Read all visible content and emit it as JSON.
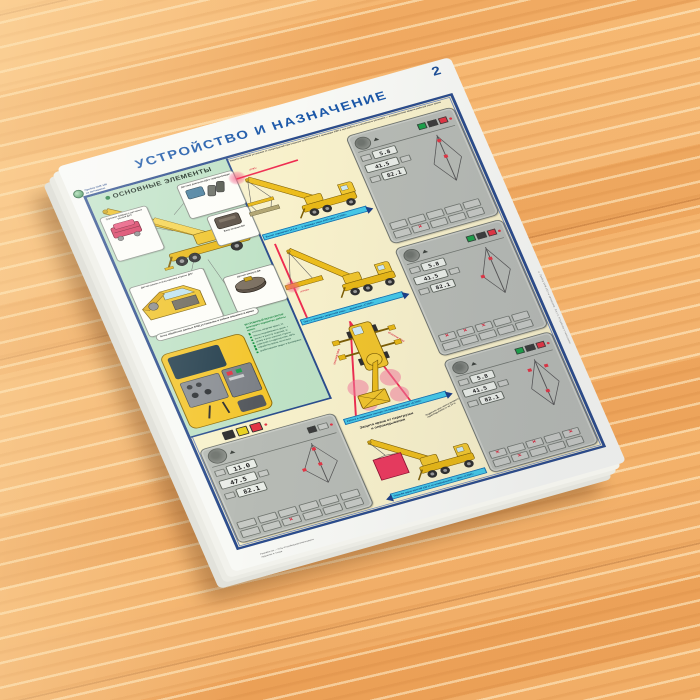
{
  "page_number": "2",
  "title": "УСТРОЙСТВО И НАЗНАЧЕНИЕ",
  "badge": {
    "line1": "Прибор ОНК-140",
    "line2": "на автокранах"
  },
  "left_panel": {
    "heading": "ОСНОВНЫЕ ЭЛЕМЕНТЫ",
    "callouts": {
      "winch": "Грузовая лебёдка с датчиком усилия ДУС",
      "pressure": "Датчики давления ДД в гидроцилиндре",
      "power": "Блок питания БП",
      "boom": "Датчик длины и угла наклона стрелы ДЛУ",
      "azimuth": "Датчик азимута ДА"
    },
    "cabin_note": "Блок обработки данных БОД установлен в кабине машиниста крана",
    "register": {
      "heading": "ВСТРОЕННЫЙ РЕГИСТРАТОР фиксирует параметры работы крана:",
      "items": [
        "степень загрузки крана, %",
        "массу поднимаемого груза, т",
        "вылет и высоту подъёма, м",
        "длину и угол наклона стрелы",
        "давление в гидросистеме, МПа",
        "наработку крана, моточасы",
        "срабатывания защит и блокировок"
      ]
    }
  },
  "middle": {
    "intro": "Защита крановой установки от повреждений при опасном приближении к проводам ЛЭП и при работе в стеснённых условиях — координатная защита рабочей зоны крана",
    "lep_label": "«ЛЭП»",
    "stop_label": "«СТОП»",
    "zone_label": "ОПАСНАЯ ЗОНА",
    "caption_top": "Вылет ограничен 14,1 м — у границы зоны ЛЭП кран «СТОП»",
    "caption_mid": "Груз у границы запретной зоны — движение «СТОП»",
    "caption_plan": "Работа в заданном секторе: на границе поворот «СТОП»"
  },
  "overload": {
    "heading_line1": "Защита крана от перегрузки",
    "heading_line2": "и опрокидывания",
    "note": "Подвешен груз, масса которого превышает грузоподъёмность на 10 %",
    "caption": "Подъём груза массой 110 % от номинальной — кран «СТОП»"
  },
  "panels": [
    {
      "name": "panel-top",
      "displays": [
        "5.8",
        "41.5",
        "82.1"
      ]
    },
    {
      "name": "panel-middle",
      "displays": [
        "5.8",
        "41.5",
        "82.1"
      ]
    },
    {
      "name": "panel-bottom",
      "displays": [
        "5.8",
        "41.5",
        "82.1"
      ]
    },
    {
      "name": "panel-large",
      "displays": [
        "11.0",
        "47.5",
        "82.1"
      ]
    }
  ],
  "icons": {
    "alarm_x": "✕"
  },
  "credits": {
    "line1": "Разработчик — НТЦ «Строймашавтоматизация»",
    "line2": "Художник А. Сизов",
    "edge": "© Прибор ОНК-140 на автокранах. Лист 2. Устройство и назначение"
  },
  "colors": {
    "wood": "#f3b068",
    "frame_blue": "#2b4c8d",
    "title_blue": "#1a57a8",
    "green_bg": "#bfe2c6",
    "cream_bg": "#f8f1cb",
    "panel_gray": "#b7bbb5",
    "crane_yellow": "#edbd1c",
    "alarm_red": "#e23544",
    "caption_cyan": "#45c9e8",
    "glow_pink": "#f27b9e"
  }
}
